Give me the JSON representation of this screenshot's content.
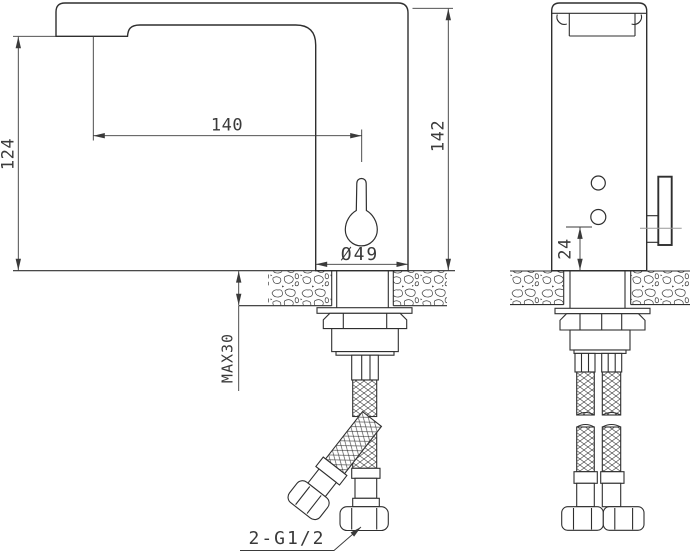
{
  "drawing": {
    "labels": {
      "spout_height": "124",
      "spout_reach": "140",
      "total_height": "142",
      "base_diameter": "Ø49",
      "max_deck_thickness": "MAX30",
      "sensor_height": "24",
      "hose_thread": "2-G1/2"
    },
    "colors": {
      "line": "#2f2f2f",
      "dimension": "#3a3a3a",
      "centerline": "#999999",
      "background": "#ffffff"
    }
  }
}
